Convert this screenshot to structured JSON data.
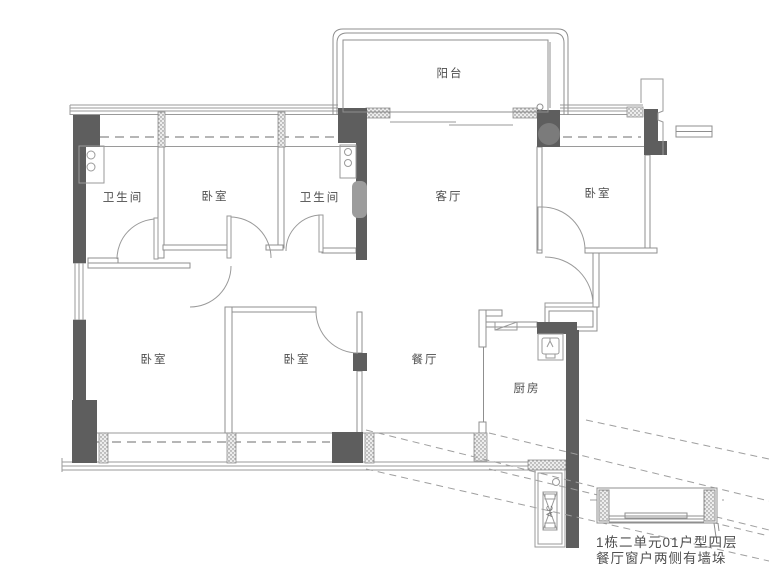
{
  "plan": {
    "rooms": {
      "balcony": "阳台",
      "bathroom_left": "卫生间",
      "bedroom_top": "卧室",
      "bathroom_middle": "卫生间",
      "living_room": "客厅",
      "bedroom_right": "卧室",
      "bedroom_bottom_left": "卧室",
      "bedroom_bottom_middle": "卧室",
      "dining_room": "餐厅",
      "kitchen": "厨房"
    },
    "equipment": {
      "ac_unit": "AC"
    },
    "caption": {
      "line1": "1栋二单元01户型四层",
      "line2": "餐厅窗户两侧有墙垛"
    },
    "colors": {
      "wall_dark": "#5e5e5e",
      "line_gray": "#8f8f8f",
      "text_gray": "#4f4f4f"
    }
  }
}
